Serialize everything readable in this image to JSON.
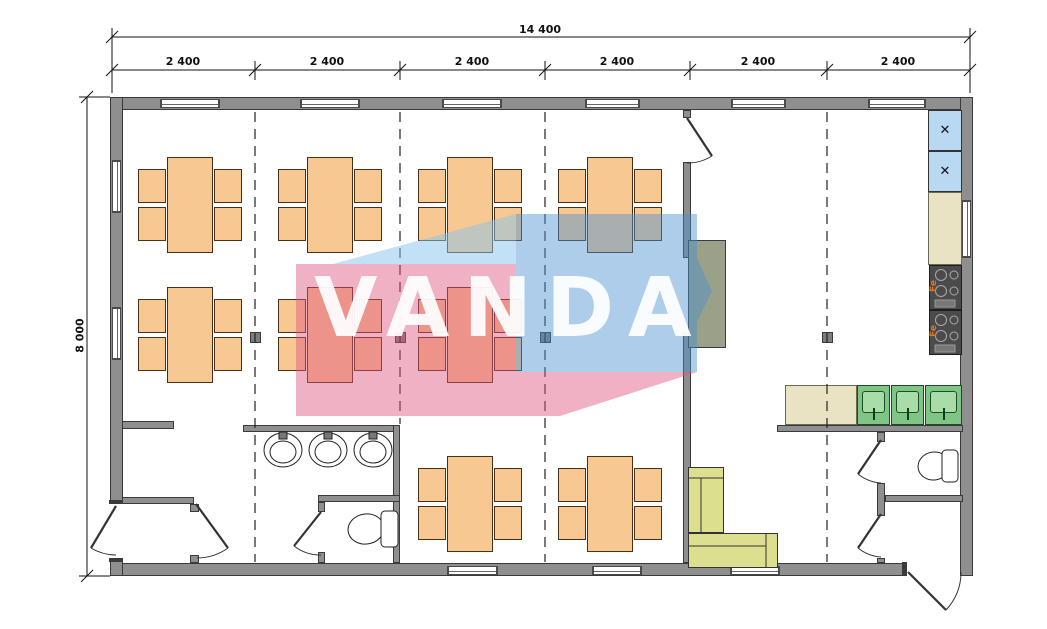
{
  "dimensions": {
    "total_width_label": "14 400",
    "module_labels": [
      "2 400",
      "2 400",
      "2 400",
      "2 400",
      "2 400",
      "2 400"
    ],
    "height_label": "8 000"
  },
  "watermark": {
    "text": "VANDA",
    "pink": "#E0527E",
    "blue": "#4A90D0",
    "light_blue": "#85C4EE",
    "text_color": "#FFFFFF"
  },
  "symbols": {
    "refrigerator_mark": "✕",
    "stove_mark": "Fe"
  },
  "palette": {
    "wall_fill": "#8F8F8F",
    "wall_edge": "#3A3A3A",
    "furniture_orange": "#F8C893",
    "furniture_edge": "#4A3019",
    "sofa_green": "#DCDF8E",
    "sink_green": "#7FC583",
    "sink_inner": "#A8DCA8",
    "fridge_blue": "#B9D8F2",
    "counter_beige": "#EAE3C3",
    "stove_gray": "#4B4B4B",
    "serving_khaki": "#9BA189",
    "flame_orange": "#E0761C"
  }
}
